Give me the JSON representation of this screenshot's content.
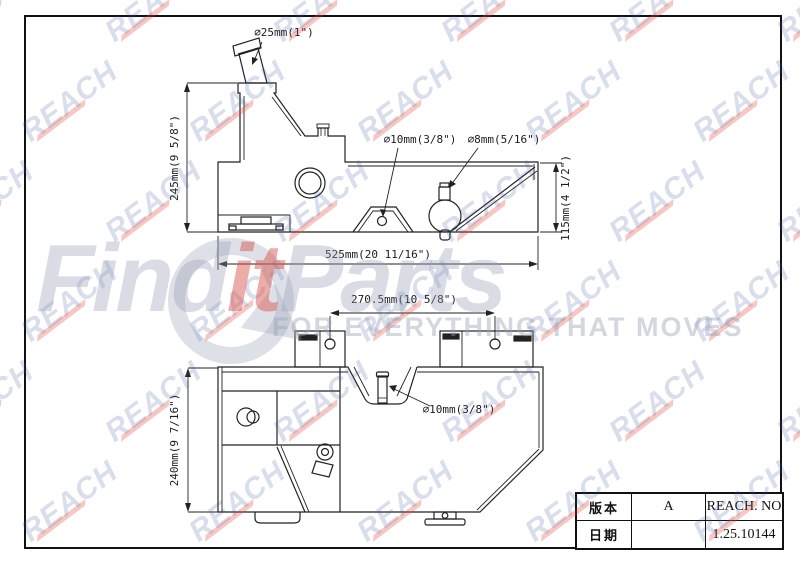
{
  "drawing": {
    "labels": {
      "neck_dia": "⌀25mm(1\")",
      "top_hole_dia": "⌀10mm(3/8\")",
      "vent_dia": "⌀8mm(5/16\")",
      "height_total": "245mm(9 5/8\")",
      "height_right": "115mm(4 1/2\")",
      "length_total": "525mm(20 11/16\")",
      "bracket_spacing": "270.5mm(10 5/8\")",
      "pin_dia": "⌀10mm(3/8\")",
      "height_front": "240mm(9 7/16\")"
    }
  },
  "title_block": {
    "rows": [
      {
        "label": "版本",
        "value": "A",
        "right": "REACH. NO"
      },
      {
        "label": "日期",
        "value": "",
        "right": "1.25.10144"
      }
    ]
  },
  "watermark": {
    "brand_text": "REACH",
    "brand_color": "#3e589e",
    "swoosh_color": "#e04638",
    "logo_find": "Find",
    "logo_it": "it",
    "logo_parts": "Parts",
    "tagline": "FOR EVERYTHING THAT MOVES"
  }
}
